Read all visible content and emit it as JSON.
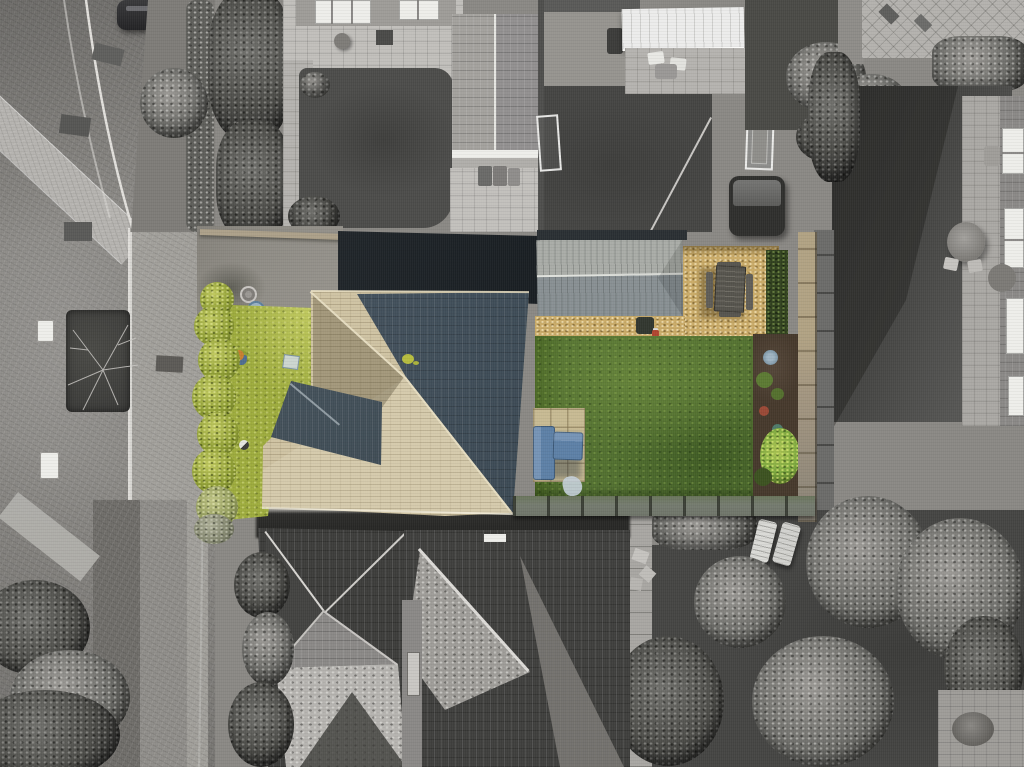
{
  "meta": {
    "type": "aerial-drone-photograph",
    "description": "Top-down aerial photograph of a detached house and its gardens shown in selective colour; the surrounding street, neighbouring houses and gardens are desaturated greyscale. No text, UI controls or labels are visible in the image.",
    "style": "selective-colour real-estate drone shot, directly overhead (nadir) view"
  },
  "palette": {
    "road": "#8a8884",
    "roadHi": "#b5b3af",
    "curb": "#e4e2de",
    "grayLawn": "#4b4b49",
    "grayLawnDark": "#393937",
    "grayPatio": "#c1bfbb",
    "grayRoofLight": "#a7a5a1",
    "grayRoofDark": "#3d3d3b",
    "grayTree": "#6e6e6a",
    "whiteTrim": "#eeeeea",
    "tarmac": "#23292e",
    "driveConcrete": "#8f8c85",
    "wallTan": "#aca089",
    "grassFront": "#9dab3d",
    "grassFrontHi": "#c0c95f",
    "hedgeFront": "#8d9c33",
    "lawn": "#527030",
    "lawnHi": "#648239",
    "lawnShadow": "#3e5a23",
    "roofCream": "#cfc3a3",
    "roofCreamShade": "#b5a988",
    "roofRidge": "#e6ddc1",
    "slate": "#42525f",
    "slateDark": "#36434f",
    "extensionTop": "#a9aca7",
    "extensionBottom": "#889093",
    "gravel": "#c9aa67",
    "gravelHi": "#e3cc90",
    "soil": "#46392c",
    "plant": "#7ca83e",
    "plantHi": "#abc452",
    "fenceTan": "#b1a283",
    "fenceGray": "#8a8377",
    "paver": "#c7ba93",
    "sofa": "#5d80a6",
    "sofaHi": "#7694b6",
    "sofaShadow": "#3e5f87",
    "tableWood": "#55534c",
    "pergola": "#6f7569"
  },
  "objects": [
    {
      "name": "street",
      "description": "curved block-paved residential road with white kerb lines, lower left",
      "color": "#8a8884"
    },
    {
      "name": "parked-car",
      "description": "dark car parked at top of road",
      "color": "#2e2e30"
    },
    {
      "name": "street-planting-bed",
      "description": "dark rectangular planting bed with bare tree in pavement",
      "color": "#3b3b39"
    },
    {
      "name": "front-hedge",
      "description": "yellow-green hedge along front boundary (in colour)",
      "color": "#8d9c33"
    },
    {
      "name": "front-lawn",
      "description": "yellow-green front grass strip with toys and a paving slab",
      "color": "#9dab3d"
    },
    {
      "name": "concrete-driveway",
      "description": "grey front driveway with two manhole covers",
      "color": "#8f8c85"
    },
    {
      "name": "tarmac-drive",
      "description": "very dark rear drive/patio in shadow above the house",
      "color": "#23292e"
    },
    {
      "name": "main-roof-cream",
      "description": "cream/limestone tiled hipped roof of the subject house",
      "color": "#cfc3a3"
    },
    {
      "name": "main-roof-slate",
      "description": "large dark blue-grey slate roof plane of the subject house",
      "color": "#42525f"
    },
    {
      "name": "porch-roof-slate",
      "description": "small dark slate hip roof projecting on the south-west side",
      "color": "#42525f"
    },
    {
      "name": "rear-extension-roof",
      "description": "single-storey rear extension with grey ridged roof",
      "color": "#a9aca7"
    },
    {
      "name": "gravel-patio",
      "description": "golden gravel / bark seating area behind the house",
      "color": "#c9aa67"
    },
    {
      "name": "dining-table-set",
      "description": "dark wooden garden dining table with benches on the gravel",
      "color": "#55534c"
    },
    {
      "name": "rear-lawn",
      "description": "green back lawn (in colour)",
      "color": "#527030"
    },
    {
      "name": "flower-bed",
      "description": "dark soil border with shrubs and a bright green plant",
      "color": "#46392c"
    },
    {
      "name": "garden-fence",
      "description": "tan-to-grey close-board fence on right boundary",
      "color": "#b1a283"
    },
    {
      "name": "garden-sofa-set",
      "description": "blue L-shaped garden sofa on tan paving slabs",
      "color": "#5d80a6"
    },
    {
      "name": "pergola-fence-line",
      "description": "grey rail/pergola line with posts across the bottom of the garden",
      "color": "#6f7569"
    },
    {
      "name": "neighbor-garage",
      "description": "grey gabled garage roof, top centre neighbour",
      "color": "#a3a19d"
    },
    {
      "name": "conservatory-skylights",
      "description": "white-framed skylights of neighbouring house, top edge",
      "color": "#eeeeea"
    },
    {
      "name": "awning",
      "description": "white ribbed awning/canopy, top centre",
      "color": "#ececeb"
    },
    {
      "name": "hot-tub",
      "description": "dark covered hot tub in neighbour garden",
      "color": "#2f2f2d"
    },
    {
      "name": "trampoline-frame",
      "description": "white rectangular frame (trampoline/goal) in neighbour garden",
      "color": "#ececea"
    },
    {
      "name": "football-goal",
      "description": "white goal frame on neighbour lawn",
      "color": "#e8e8e6"
    },
    {
      "name": "neighbor-lawns",
      "description": "desaturated dark lawns of neighbouring gardens",
      "color": "#4b4b49"
    },
    {
      "name": "neighbor-house-right",
      "description": "right-hand neighbour house edge with white windows and patio table",
      "color": "#8a8886"
    },
    {
      "name": "sun-loungers",
      "description": "two pale sun loungers in bottom-right garden",
      "color": "#dadad6"
    },
    {
      "name": "bottom-house-roofs",
      "description": "large grey hipped/gabled roofs of houses at bottom",
      "color": "#3d3d3b"
    },
    {
      "name": "garden-trees",
      "description": "speckled grey trees and shrubs throughout surroundings",
      "color": "#6e6e6a"
    },
    {
      "name": "stepping-stone-path",
      "description": "light path with small pavers, bottom centre-right",
      "color": "#a8a6a2"
    }
  ]
}
